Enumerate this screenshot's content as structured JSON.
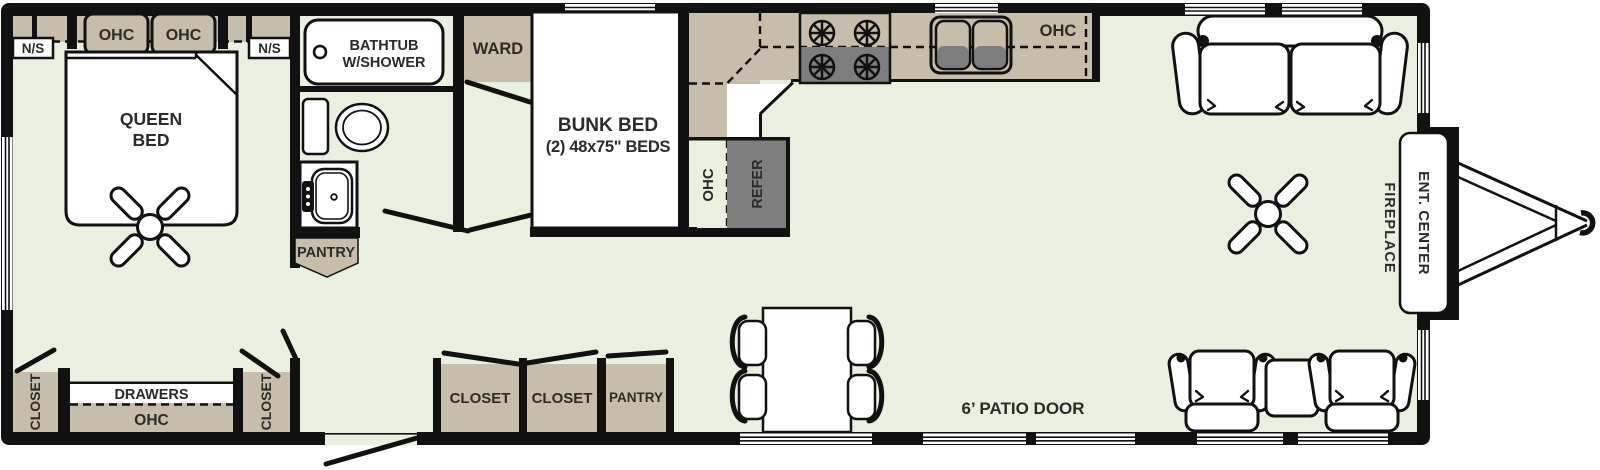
{
  "colors": {
    "floor": "#E9F0E0",
    "cabinetry": "#C7BDAB",
    "appliance_gray": "#7E7E7E",
    "wall": "#111111",
    "label_text": "#2B2B2B"
  },
  "bedroom": {
    "ohc1": "OHC",
    "ohc2": "OHC",
    "ns_left": "N/S",
    "ns_right": "N/S",
    "queen1": "QUEEN",
    "queen2": "BED",
    "closet_left": "CLOSET",
    "closet_right": "CLOSET",
    "drawers": "DRAWERS",
    "drawers_ohc": "OHC"
  },
  "bathroom": {
    "tub1": "BATHTUB",
    "tub2": "W/SHOWER",
    "pantry": "PANTRY"
  },
  "hall": {
    "ward": "WARD",
    "closet1": "CLOSET",
    "closet2": "CLOSET",
    "pantry": "PANTRY"
  },
  "bunk": {
    "line1": "BUNK BED",
    "line2": "(2) 48x75\" BEDS"
  },
  "kitchen": {
    "ohc_upper": "OHC",
    "ohc_lower": "OHC",
    "refer": "REFER"
  },
  "living": {
    "patio": "6’ PATIO DOOR",
    "fireplace": "FIREPLACE",
    "ent": "ENT. CENTER"
  }
}
